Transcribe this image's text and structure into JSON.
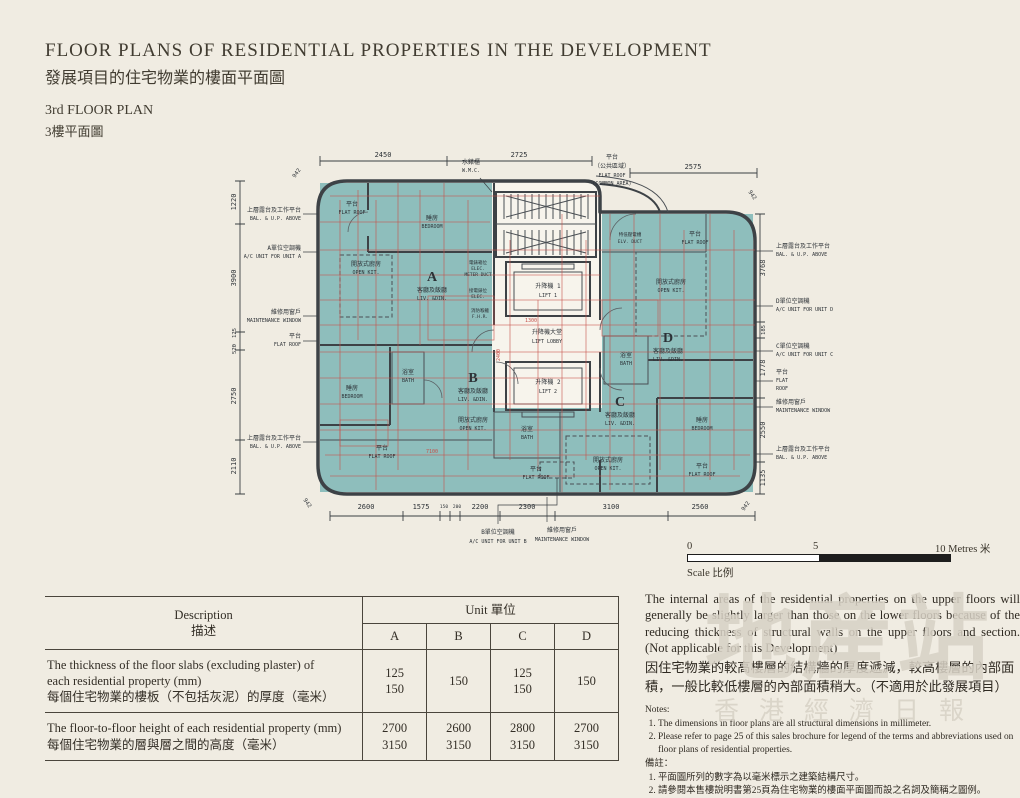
{
  "header": {
    "title_en": "FLOOR PLANS OF RESIDENTIAL PROPERTIES IN THE DEVELOPMENT",
    "title_zh": "發展項目的住宅物業的樓面平面圖",
    "floor_en": "3rd FLOOR PLAN",
    "floor_zh": "3樓平面圖"
  },
  "plan": {
    "units": {
      "a": "A",
      "b": "B",
      "c": "C",
      "d": "D"
    },
    "rooms": {
      "living_dining": {
        "zh": "客廳及飯廳",
        "en": "LIV. &DIN."
      },
      "bedroom": {
        "zh": "睡房",
        "en": "BEDROOM"
      },
      "bath": {
        "zh": "浴室",
        "en": "BATH"
      },
      "open_kitchen": {
        "zh": "開放式廚房",
        "en": "OPEN KIT."
      },
      "flat_roof": {
        "zh": "平台",
        "en": "FLAT ROOF"
      },
      "flat_roof_3line": {
        "zh": "平台",
        "en1": "FLAT",
        "en2": "ROOF"
      },
      "flat_roof_common": {
        "zh1": "平台",
        "zh2": "（公共區域）",
        "en1": "FLAT ROOF",
        "en2": "(COMMON AREA)"
      },
      "lift1": {
        "zh": "升降機 1",
        "en": "LIFT 1"
      },
      "lift2": {
        "zh": "升降機 2",
        "en": "LIFT 2"
      },
      "lift_lobby": {
        "zh": "升降機大堂",
        "en": "LIFT LOBBY"
      },
      "wmc": {
        "zh": "水錶櫃",
        "en": "W.M.C."
      },
      "elec_meter": {
        "zh": "電錶箱位",
        "en1": "ELEC.",
        "en2": "METER DUCT"
      },
      "elec": {
        "zh": "接電錶位",
        "en": "ELEC."
      },
      "fire_hose": {
        "zh": "消防喉轆",
        "en": "F.H.R."
      },
      "elv": {
        "zh": "特低壓電槽",
        "en": "ELV. DUCT"
      }
    },
    "callouts": {
      "bal_up": {
        "zh": "上層露台及工作平台",
        "en": "BAL. & U.P. ABOVE"
      },
      "ac_unit_a": {
        "zh": "A單位空調機",
        "en": "A/C UNIT FOR UNIT A"
      },
      "ac_unit_b": {
        "zh": "B單位空調機",
        "en": "A/C UNIT FOR UNIT B"
      },
      "ac_unit_c": {
        "zh": "C單位空調機",
        "en": "A/C UNIT FOR UNIT C"
      },
      "ac_unit_d": {
        "zh": "D單位空調機",
        "en": "A/C UNIT FOR UNIT D"
      },
      "maintenance_window": {
        "zh": "維修用窗戶",
        "en": "MAINTENANCE WINDOW"
      }
    },
    "dims": {
      "top": [
        "2450",
        "2725",
        "2575"
      ],
      "left": [
        "1220",
        "3900",
        "125",
        "520",
        "2750",
        "2110"
      ],
      "right": [
        "3768",
        "185",
        "1778",
        "2550",
        "1135"
      ],
      "bottom": [
        "2600",
        "1575",
        "150",
        "200",
        "2200",
        "2300",
        "3100",
        "2560"
      ],
      "corner_radius": "942",
      "red": [
        "1300",
        "2400",
        "7100"
      ]
    }
  },
  "scale_bar": {
    "tick0": "0",
    "tick5": "5",
    "tick10": "10 Metres 米",
    "caption": "Scale 比例"
  },
  "table": {
    "desc_header_en": "Description",
    "desc_header_zh": "描述",
    "unit_header": "Unit 單位",
    "columns": [
      "A",
      "B",
      "C",
      "D"
    ],
    "rows": [
      {
        "desc_en": "The thickness of the floor slabs (excluding plaster) of\neach residential property (mm)",
        "desc_zh": "每個住宅物業的樓板（不包括灰泥）的厚度（毫米）",
        "values": [
          "125\n150",
          "150",
          "125\n150",
          "150"
        ]
      },
      {
        "desc_en": "The floor-to-floor height of each residential property (mm)",
        "desc_zh": "每個住宅物業的層與層之間的高度（毫米）",
        "values": [
          "2700\n3150",
          "2600\n3150",
          "2800\n3150",
          "2700\n3150"
        ]
      }
    ]
  },
  "info": {
    "para_en": "The internal areas of the residential properties on the upper floors will generally be slightly larger than those on the lower floors because of the reducing thickness of structural walls on the upper floors and section. (Not applicable for this Development)",
    "para_zh": "因住宅物業的較高樓層的結構牆的厚度遞減，較高樓層的內部面積，一般比較低樓層的內部面積稍大。（不適用於此發展項目）",
    "notes_title": "Notes:",
    "notes_en": [
      "The dimensions in floor plans are all structural dimensions in millimeter.",
      "Please refer to page 25 of this sales brochure for legend of the terms and abbreviations used on floor plans of residential properties."
    ],
    "notes_title_zh": "備註：",
    "notes_zh": [
      "平面圖所列的數字為以毫米標示之建築結構尺寸。",
      "請參閱本售樓說明書第25頁為住宅物業的樓面平面圖而設之名詞及簡稱之圖例。"
    ]
  },
  "watermark": {
    "line1": "地産站",
    "line2": "香港經濟日報"
  }
}
